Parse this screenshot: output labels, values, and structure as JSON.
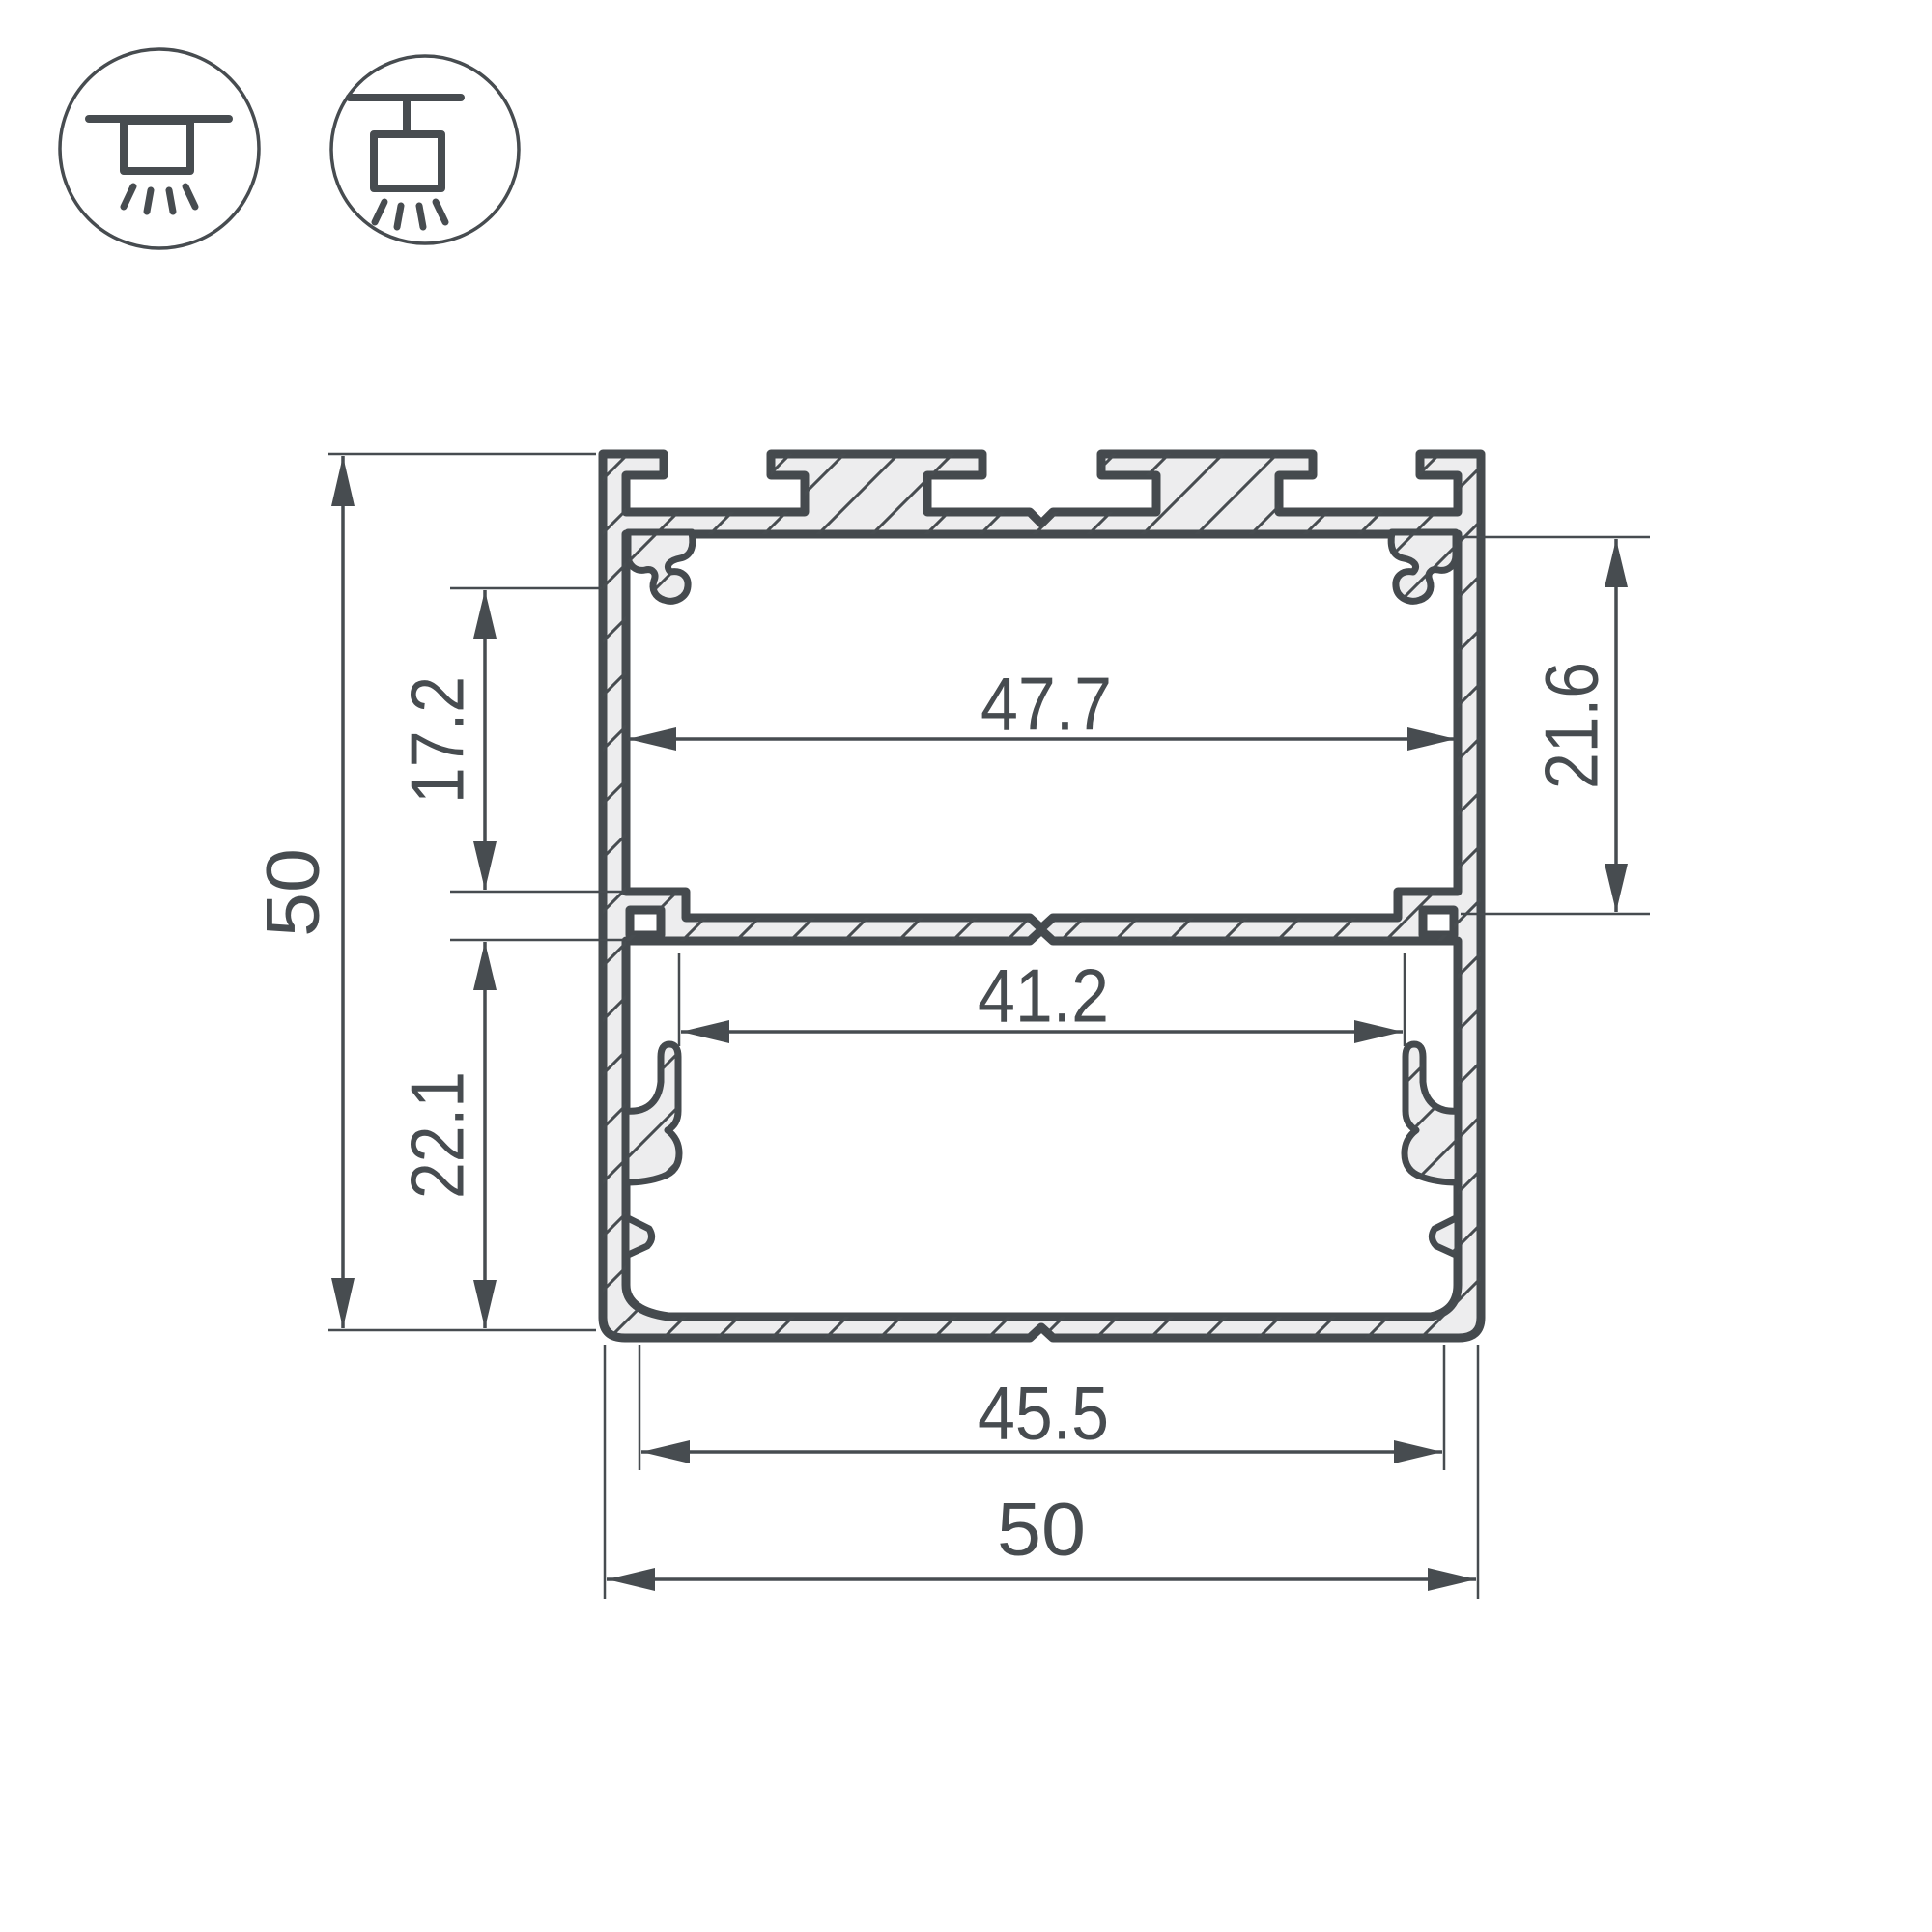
{
  "drawing": {
    "title": "aluminium-profile-cross-section",
    "dimensions": {
      "overall_height": "50",
      "upper_inner_height": "17.2",
      "lower_inner_height": "22.1",
      "right_inner_height": "21.6",
      "upper_inner_width": "47.7",
      "middle_inner_width": "41.2",
      "bottom_inner_width": "45.5",
      "overall_width": "50"
    },
    "colors": {
      "line": "#474c50",
      "profile_fill": "#ededee",
      "background": "#ffffff"
    },
    "icons": [
      {
        "name": "surface-ceiling-mount"
      },
      {
        "name": "pendant-suspended-mount"
      }
    ]
  }
}
